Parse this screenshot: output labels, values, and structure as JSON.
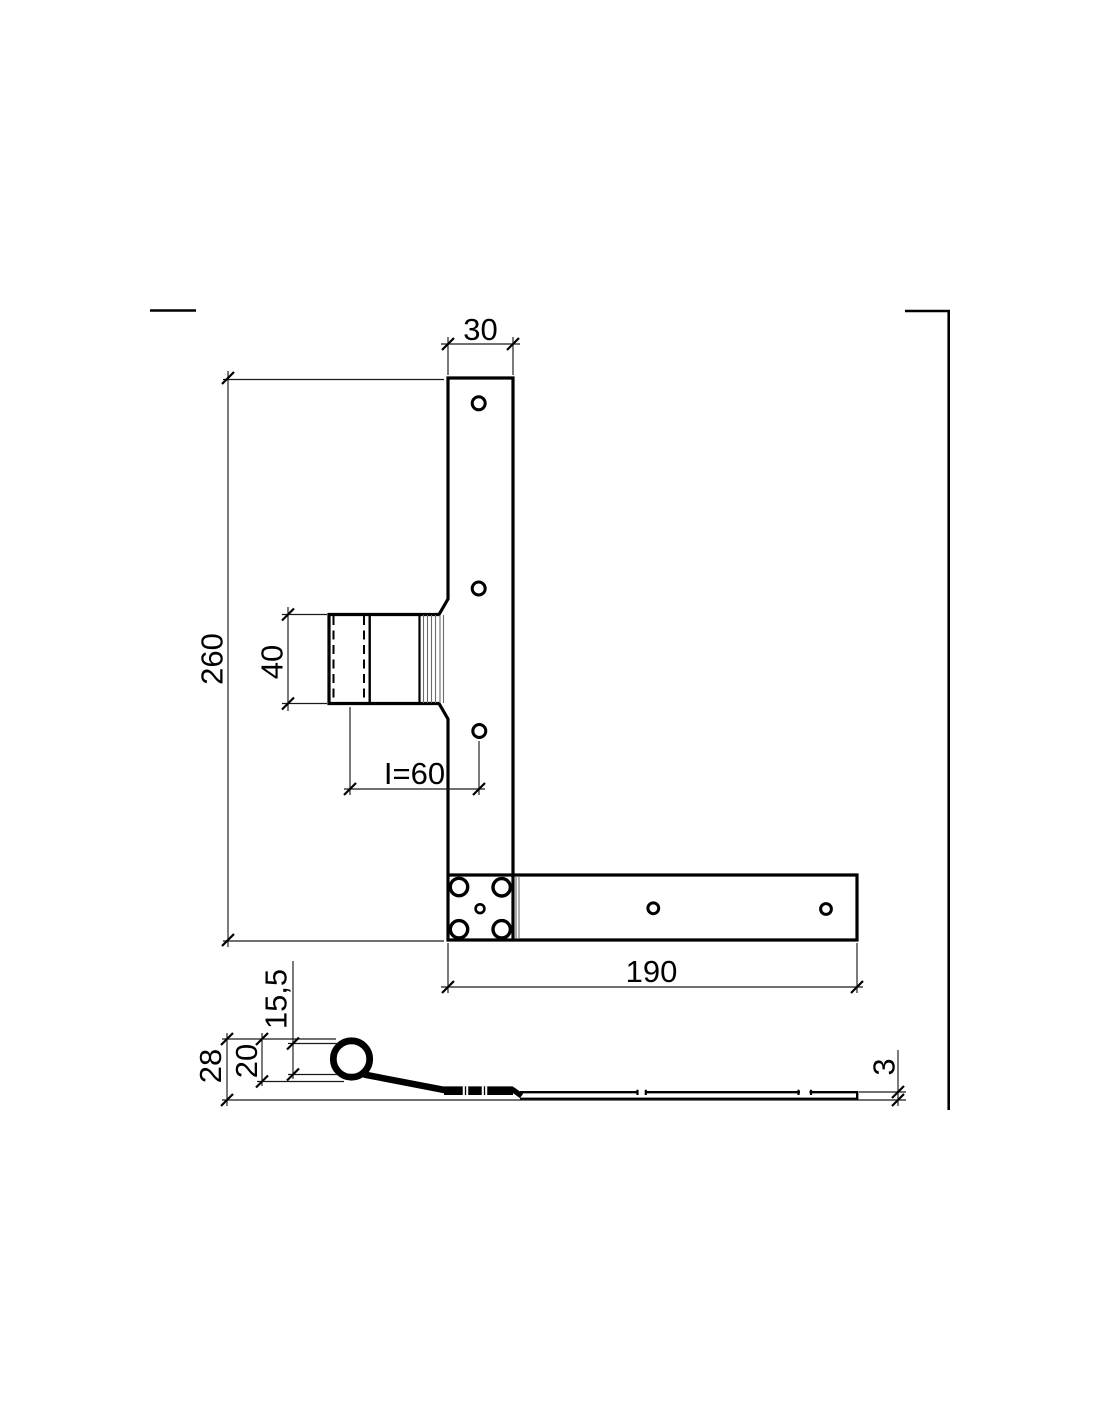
{
  "drawing": {
    "kind": "technical drawing",
    "part": "angle hinge (L-shaped window shutter hinge), two orthographic views",
    "front_view": {
      "strap_width": "30",
      "overall_height": "260",
      "knuckle_height": "40",
      "pin_to_first_hole": "I=60",
      "strap_length": "190"
    },
    "side_view": {
      "overall_height": "28",
      "eye_outer_diameter": "20",
      "eye_inner_diameter": "15,5",
      "thickness": "3"
    }
  }
}
